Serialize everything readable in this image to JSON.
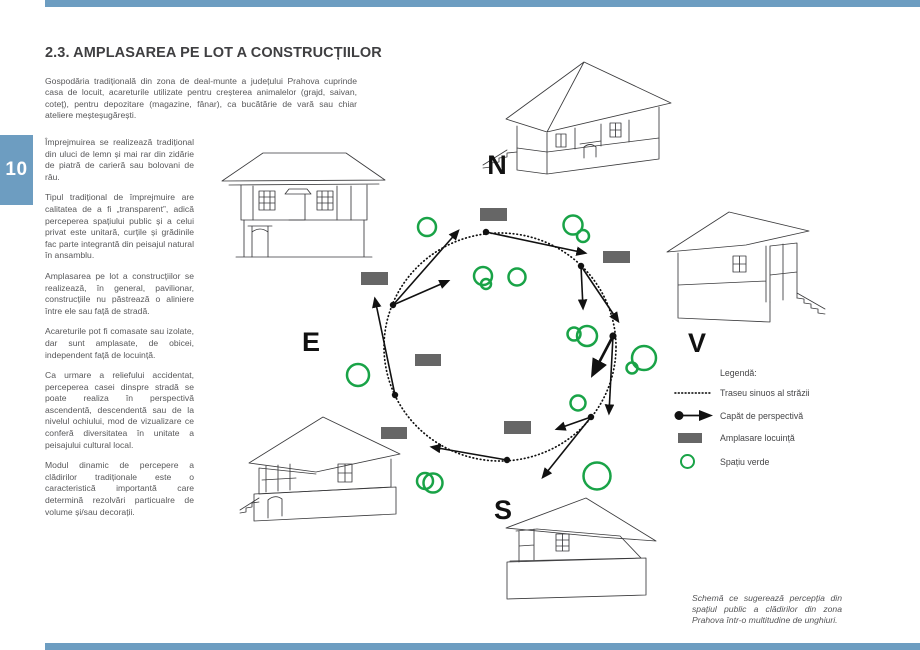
{
  "page": {
    "number": "10",
    "title": "2.3. AMPLASAREA PE LOT A CONSTRUCȚIILOR",
    "accent_color": "#6d9dc1"
  },
  "article": {
    "intro": "Gospodăria tradițională din zona de deal-munte a județului Prahova cuprinde casa de locuit, acareturile utilizate pentru creșterea animalelor (grajd, saivan, coteț), pentru depozitare (magazine, fânar), ca bucătărie de vară sau chiar ateliere meșteșugărești.",
    "paragraphs": [
      "Împrejmuirea se realizează tradițional din uluci de lemn și mai rar din zidărie de piatră de carieră sau bolovani de râu.",
      "Tipul tradițional de împrejmuire are calitatea de a fi „transparent”, adică perceperea spațiului public și a celui privat este unitară, curțile și grădinile fac parte integrantă din peisajul natural în ansamblu.",
      "Amplasarea pe lot a construcțiilor se realizează, în general, pavilionar, construcțiile nu păstrează o aliniere între ele sau față de stradă.",
      "Acareturile pot fi comasate sau izolate, dar sunt amplasate, de obicei, independent față de locuință.",
      "Ca urmare a reliefului accidentat, perceperea casei dinspre stradă se poate realiza în perspectivă ascendentă, descendentă sau de la nivelul ochiului, mod de vizualizare ce conferă diversitatea în unitate a peisajului cultural local.",
      "Modul dinamic de percepere a clădirilor tradiționale este o caracteristică importantă care determină rezolvări particualre de volume și/sau decorații."
    ]
  },
  "diagram": {
    "compass": {
      "north": "N",
      "east": "E",
      "west": "V",
      "south": "S"
    },
    "colors": {
      "green": "#19a347",
      "gray": "#666666"
    },
    "legend": {
      "title": "Legendă:",
      "items": [
        {
          "icon": "dotted-line-icon",
          "label": "Traseu sinuos al străzii"
        },
        {
          "icon": "perspective-arrow-icon",
          "label": "Capăt de perspectivă"
        },
        {
          "icon": "dwelling-rect-icon",
          "label": "Amplasare locuință"
        },
        {
          "icon": "green-circle-icon",
          "label": "Spațiu verde"
        }
      ]
    }
  },
  "caption": "Schemă ce sugerează percepția din spațiul public a clădirilor din zona Prahova într-o multitudine de unghiuri."
}
